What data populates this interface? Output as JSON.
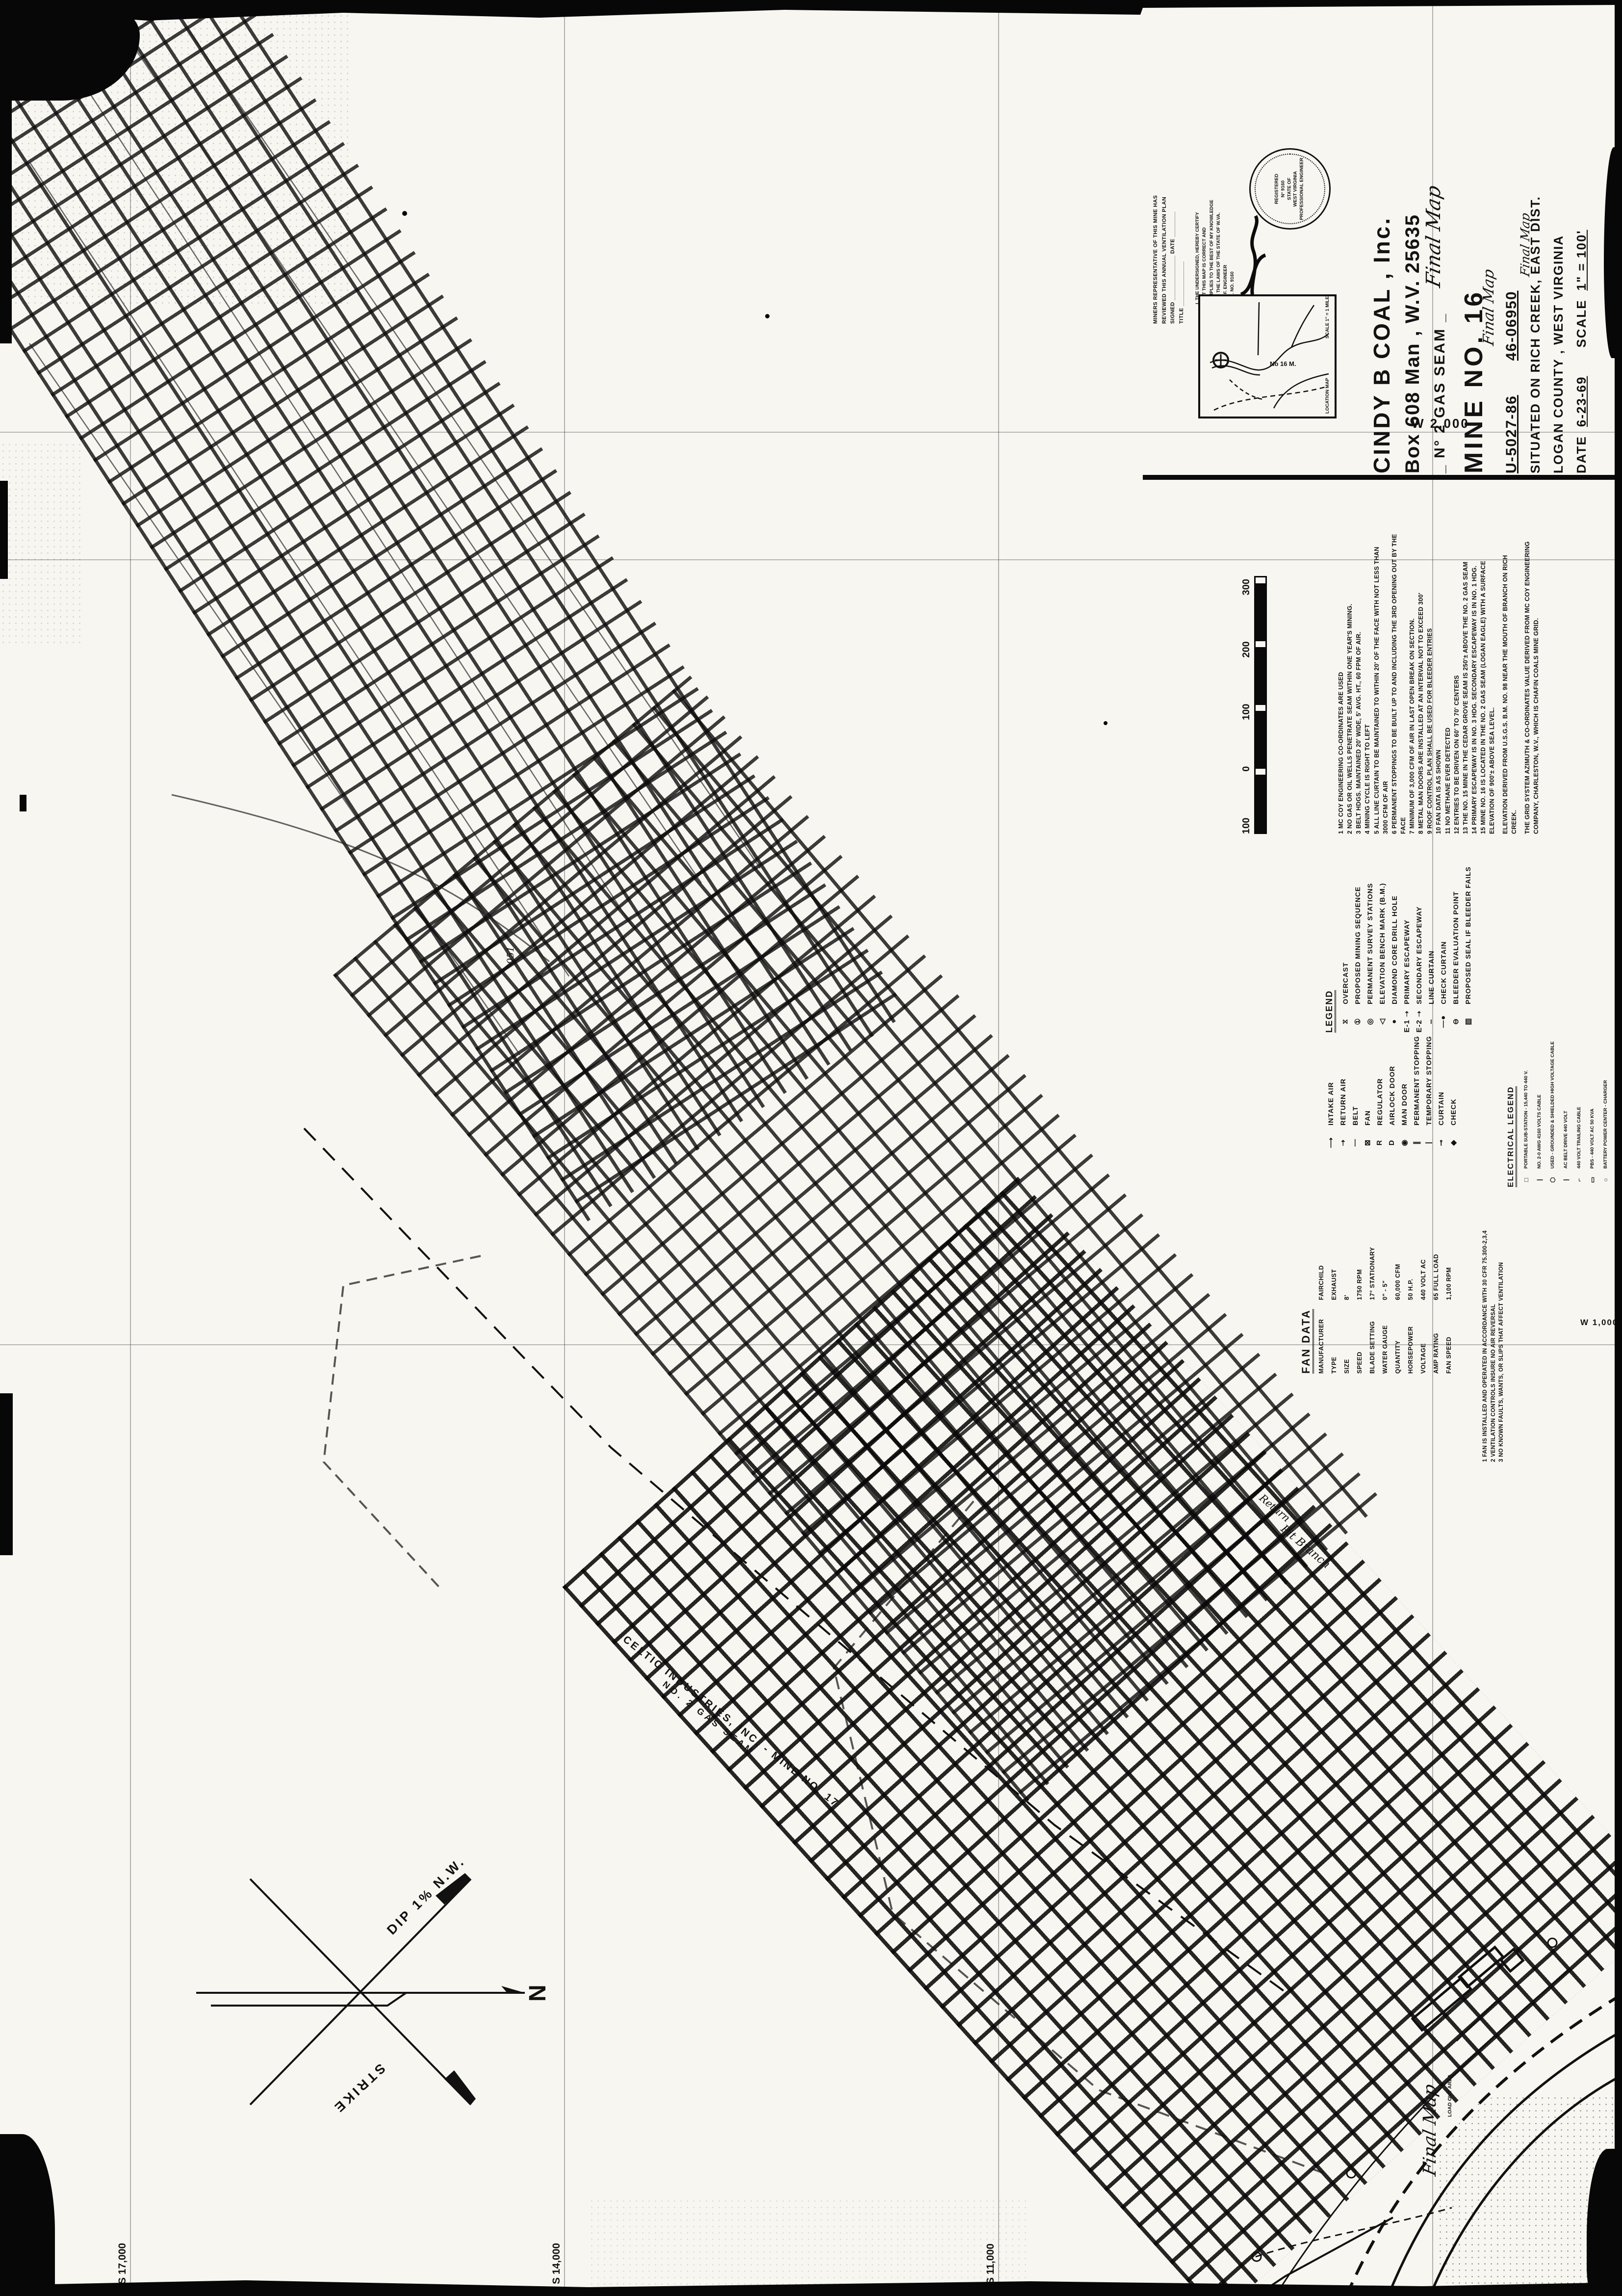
{
  "title_block": {
    "company": "CINDY  B  COAL , Inc.",
    "address": "Box 608  Man , W.V.  25635",
    "seam": "_ N° 2  GAS  SEAM _",
    "mine": "MINE  NO. 16",
    "permit_number": "U-5027-86",
    "id_number": "46-06950",
    "situated": "SITUATED ON RICH CREEK, EAST DIST.",
    "county": "LOGAN  COUNTY ,  WEST  VIRGINIA",
    "date_label": "DATE",
    "date_value": "6-23-69",
    "scale_label": "SCALE",
    "scale_value": "1\" = 100'"
  },
  "review_block": {
    "line1": "MINERS REPRESENTATIVE OF THIS MINE HAS",
    "line2": "REVIEWED THIS ANNUAL VENTILATION PLAN",
    "signed_line": "SIGNED ______________  DATE ________",
    "title_line": "TITLE ______________"
  },
  "certification": {
    "lines": [
      "I, THE UNDERSIGNED, HEREBY CERTIFY",
      "THAT THIS MAP IS CORRECT AND",
      "COMPLIES TO THE BEST OF MY KNOWLEDGE",
      "AND THE LAWS OF THE STATE OF W.VA.",
      "PROF. ENGINEER",
      "REG. NO. 9160"
    ],
    "seal": {
      "ring_top": "REGISTERED",
      "number": "N° 9160",
      "middle": "STATE OF",
      "state": "WEST VIRGINIA",
      "ring_bottom": "PROFESSIONAL ENGINEER"
    }
  },
  "inset_map": {
    "label": "No 16 M.",
    "scale_note": "SCALE 1\" = 1 MILE",
    "side_label": "LOCATION MAP"
  },
  "grid_labels": {
    "w2000": "W 2,000",
    "w1000": "W 1,000",
    "s17000": "S 17,000",
    "s14000": "S 14,000",
    "s11000": "S 11,000"
  },
  "legend": {
    "heading": "LEGEND",
    "items": [
      {
        "symbol": "⧖",
        "label": "OVERCAST"
      },
      {
        "symbol": "①",
        "label": "PROPOSED MINING SEQUENCE"
      },
      {
        "symbol": "◎",
        "label": "PERMANENT SURVEY STATIONS"
      },
      {
        "symbol": "◁",
        "label": "ELEVATION BENCH MARK (B.M.)"
      },
      {
        "symbol": "●",
        "label": "DIAMOND CORE DRILL HOLE"
      },
      {
        "symbol": "E-1 ➝",
        "label": "PRIMARY ESCAPEWAY"
      },
      {
        "symbol": "E-2 ➝",
        "label": "SECONDARY ESCAPEWAY"
      },
      {
        "symbol": "┄",
        "label": "LINE CURTAIN"
      },
      {
        "symbol": "—●",
        "label": "CHECK CURTAIN"
      },
      {
        "symbol": "⊖",
        "label": "BLEEDER EVALUATION POINT"
      },
      {
        "symbol": "▥",
        "label": "PROPOSED SEAL IF BLEEDER FAILS"
      }
    ],
    "items2": [
      {
        "symbol": "⟶",
        "label": "INTAKE AIR"
      },
      {
        "symbol": "⇢",
        "label": "RETURN AIR"
      },
      {
        "symbol": "—",
        "label": "BELT"
      },
      {
        "symbol": "⊠",
        "label": "FAN"
      },
      {
        "symbol": "R",
        "label": "REGULATOR"
      },
      {
        "symbol": "D",
        "label": "AIRLOCK DOOR"
      },
      {
        "symbol": "◉",
        "label": "MAN DOOR"
      },
      {
        "symbol": "∥",
        "label": "PERMANENT STOPPING"
      },
      {
        "symbol": "|",
        "label": "TEMPORARY STOPPING"
      },
      {
        "symbol": "⊸",
        "label": "CURTAIN"
      },
      {
        "symbol": "◆",
        "label": "CHECK"
      }
    ]
  },
  "electrical_legend": {
    "heading": "ELECTRICAL LEGEND",
    "items": [
      {
        "symbol": "□",
        "label": "PORTABLE SUB-STATION - 15,440 TO 440 V."
      },
      {
        "symbol": "|",
        "label": "NO. 2-0 AWG 4160 VOLTS CABLE"
      },
      {
        "symbol": "⬡",
        "label": "USED - GROUNDED & SHIELDED HIGH VOLTAGE CABLE"
      },
      {
        "symbol": "|",
        "label": "AC BELT DRIVE  440 VOLT"
      },
      {
        "symbol": "⌐",
        "label": "440 VOLT TRAILING CABLE"
      },
      {
        "symbol": "▭",
        "label": "PBS - 440 VOLT AC  50 KVA"
      },
      {
        "symbol": "○",
        "label": "BATTERY POWER CENTER - CHARGER"
      }
    ]
  },
  "fan_data": {
    "heading": "FAN DATA",
    "rows": [
      {
        "label": "MANUFACTURER",
        "value": "FAIRCHILD"
      },
      {
        "label": "TYPE",
        "value": "EXHAUST"
      },
      {
        "label": "SIZE",
        "value": "8'"
      },
      {
        "label": "SPEED",
        "value": "1750 RPM"
      },
      {
        "label": "BLADE SETTING",
        "value": "17° STATIONARY"
      },
      {
        "label": "WATER GAUGE",
        "value": "0\" - 5\""
      },
      {
        "label": "QUANTITY",
        "value": "60,000 CFM"
      },
      {
        "label": "HORSEPOWER",
        "value": "50 H.P."
      },
      {
        "label": "VOLTAGE",
        "value": "440 VOLT AC"
      },
      {
        "label": "AMP RATING",
        "value": "65 FULL LOAD"
      },
      {
        "label": "FAN SPEED",
        "value": "1,100 RPM"
      }
    ],
    "notes": [
      "1  FAN IS INSTALLED AND OPERATED IN ACCORDANCE WITH 30 CFR 75.300-2,3,4",
      "2  VENTILATION CONTROLS INSURE NO AIR REVERSAL",
      "3  NO KNOWN FAULTS, WANTS, OR SLIPS THAT AFFECT VENTILATION"
    ]
  },
  "notes": {
    "items": [
      "1  MC COY ENGINEERING CO-ORDINATES ARE USED",
      "2  NO GAS OR OIL WELLS PENETRATE SEAM WITHIN ONE YEAR'S MINING.",
      "3  BELT HDGS. MAINTAINED 20' WIDE, 5' AVG. HT., 60 FPM OF AIR.",
      "4  MINING CYCLE IS RIGHT TO LEFT",
      "5  ALL LINE CURTAIN TO BE MAINTAINED TO WITHIN 20' OF THE FACE WITH NOT LESS THAN 3000 CFM OF AIR",
      "6  PERMANENT STOPPINGS TO BE BUILT UP TO AND INCLUDING THE 3RD OPENING OUT BY THE FACE",
      "7  MINIMUM OF 3,000 CFM OF AIR IN LAST OPEN BREAK ON SECTION.",
      "8  METAL MAN DOORS ARE INSTALLED AT AN INTERVAL NOT TO EXCEED 300'",
      "9  ROOF CONTROL PLAN SHALL BE USED FOR BLEEDER ENTRIES",
      "10  FAN DATA IS AS SHOWN",
      "11  NO METHANE EVER DETECTED",
      "12  ENTRIES TO BE DRIVEN ON 60' TO 70' CENTERS",
      "13  THE NO. 15 MINE IN THE CEDAR GROVE SEAM IS 250'± ABOVE THE NO. 2 GAS SEAM",
      "14  PRIMARY ESCAPEWAY IS IN NO. 3 HDG.    SECONDARY ESCAPEWAY IS IN NO. 1 HDG.",
      "15  MINE NO. 16 IS LOCATED IN THE NO. 2 GAS SEAM (LOGAN EAGLE) WITH A SURFACE ELEVATION OF 900'± ABOVE SEA LEVEL."
    ],
    "paragraphs": [
      "ELEVATION DERIVED FROM U.S.G.S.  B.M. NO. 98 NEAR THE MOUTH OF BRANCH ON RICH CREEK.",
      "THE GRID SYSTEM AZIMUTH & CO-ORDINATES VALUE DERIVED FROM MC COY ENGINEERING COMPANY, CHARLESTON, W.V., WHICH IS CHAFIN COALS MINE GRID."
    ]
  },
  "scale_bar": {
    "ticks": [
      "100",
      "0",
      "100",
      "200",
      "300"
    ]
  },
  "compass": {
    "north": "N",
    "dip": "DIP  1%  N.W.",
    "strike": "STRIKE"
  },
  "boundary": {
    "line1": "CELTIC  INDUSTRIES, INC. - MINE NO. 17",
    "line2": "NO. 2  GAS  SEAM"
  },
  "annotations": {
    "final_map": "Final Map",
    "load_out": "LOAD OUT AREA",
    "pit_branch": "Pit Branch",
    "return_note": "Return",
    "station_051": "051"
  }
}
